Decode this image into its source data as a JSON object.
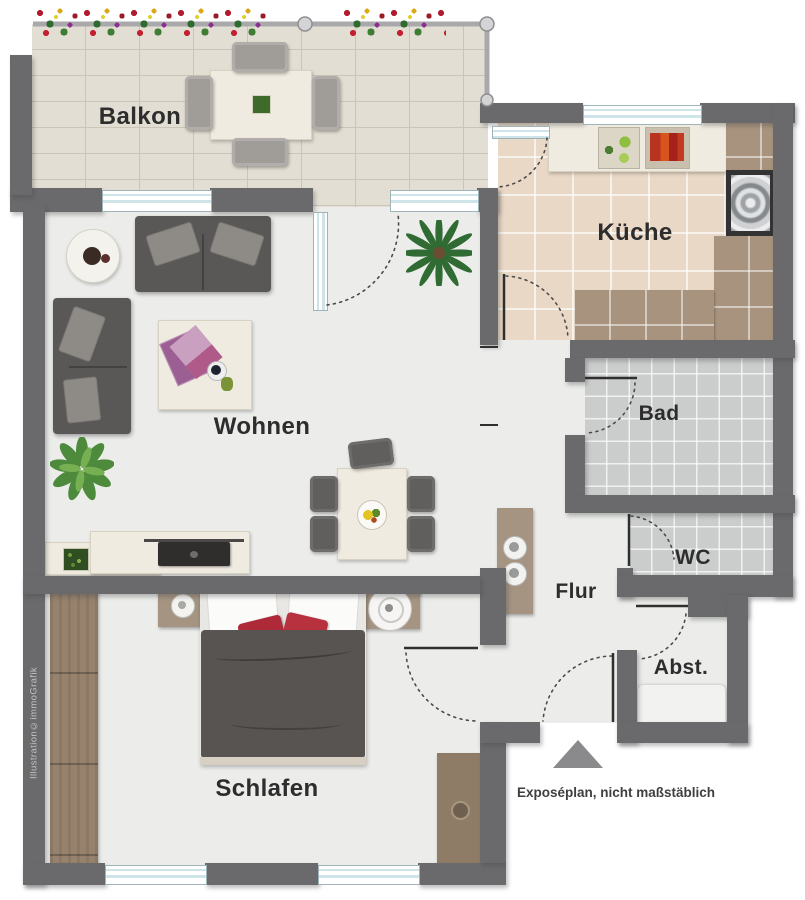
{
  "rooms": {
    "balkon": {
      "label": "Balkon"
    },
    "kueche": {
      "label": "Küche"
    },
    "wohnen": {
      "label": "Wohnen"
    },
    "bad": {
      "label": "Bad"
    },
    "wc": {
      "label": "WC"
    },
    "flur": {
      "label": "Flur"
    },
    "abstellraum": {
      "label": "Abst."
    },
    "schlafen": {
      "label": "Schlafen"
    }
  },
  "footer": {
    "note": "Exposéplan, nicht maßstäblich"
  },
  "credit": {
    "text": "Illustration©immoGrafik"
  },
  "colors": {
    "wall": "#6a6a6c",
    "interior_floor": "#ecedeb",
    "balcony_floor": "#e3ded3",
    "kitchen_floor": "#e9d8c6",
    "bath_floor": "#cbcccc",
    "wood": "#96826d",
    "sofa": "#5a5856",
    "accent_pillow": "#ae2a38",
    "window_glass": "#cfe4e9",
    "entrance_arrow": "#8a8a8c"
  }
}
